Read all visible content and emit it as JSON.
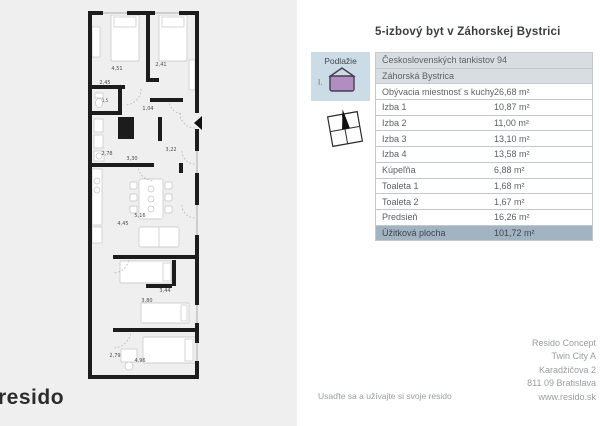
{
  "page": {
    "title": "5-izbový byt v Záhorskej Bystrici",
    "slogan": "Usaďte sa a užívajte si svoje resido",
    "brand_logo": "resido"
  },
  "floor_selector": {
    "label": "Podlažie",
    "level": "I."
  },
  "colors": {
    "selector_bg": "#cbdce6",
    "total_row_bg": "#a2b3c2",
    "house_purple": "#b18ec2",
    "panel_gray": "#efeff0"
  },
  "table": {
    "street": "Československých tankistov 94",
    "district": "Záhorská Bystrica",
    "rows": [
      {
        "label": "Obývacia miestnosť s kuchyňou",
        "value": "26,68 m²"
      },
      {
        "label": "Izba 1",
        "value": "10,87 m²"
      },
      {
        "label": "Izba 2",
        "value": "11,00 m²"
      },
      {
        "label": "Izba 3",
        "value": "13,10 m²"
      },
      {
        "label": "Izba 4",
        "value": "13,58 m²"
      },
      {
        "label": "Kúpeľňa",
        "value": "6,88 m²"
      },
      {
        "label": "Toaleta 1",
        "value": "1,68 m²"
      },
      {
        "label": "Toaleta 2",
        "value": "1,67 m²"
      },
      {
        "label": "Predsieň",
        "value": "16,26 m²"
      }
    ],
    "total": {
      "label": "Úžitková plocha",
      "value": "101,72 m²"
    }
  },
  "contact": {
    "lines": [
      "Resido Concept",
      "Twin City A",
      "Karadžičova 2",
      "811 09 Bratislava",
      "www.resido.sk"
    ]
  },
  "floorplan": {
    "dimensions": [
      "4,51",
      "2,45",
      "2,41",
      "1,5",
      "1,04",
      "2,78",
      "3,30",
      "3,22",
      "5,16",
      "4,45",
      "3,44",
      "3,80",
      "2,79",
      "4,96"
    ]
  }
}
